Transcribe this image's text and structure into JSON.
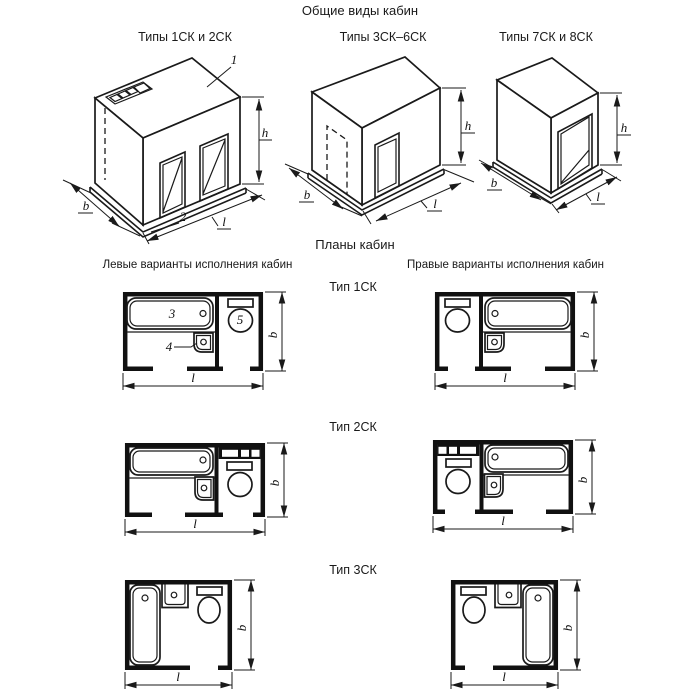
{
  "titles": {
    "main": "Общие виды кабин",
    "plans": "Планы кабин",
    "left_variants": "Левые варианты исполнения кабин",
    "right_variants": "Правые варианты исполнения кабин"
  },
  "views": [
    {
      "label": "Типы 1СК и 2СК"
    },
    {
      "label": "Типы 3СК–6СК"
    },
    {
      "label": "Типы 7СК и 8СК"
    }
  ],
  "rows": [
    {
      "label": "Тип 1СК"
    },
    {
      "label": "Тип 2СК"
    },
    {
      "label": "Тип 3СК"
    }
  ],
  "dims": {
    "b": "b",
    "l": "l",
    "h": "h"
  },
  "callouts": {
    "roof": "1",
    "base": "2",
    "bath": "3",
    "washbasin": "4",
    "toilet": "5"
  },
  "colors": {
    "ink": "#1a1a1a",
    "wall": "#111111",
    "background": "#ffffff"
  }
}
